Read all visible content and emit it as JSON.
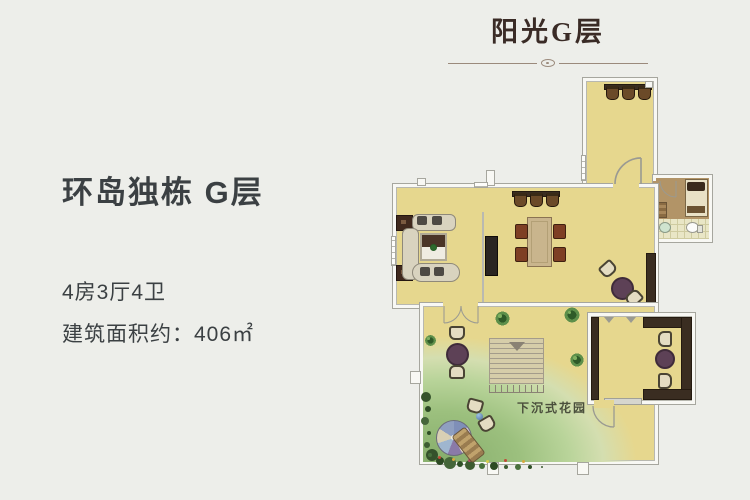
{
  "page": {
    "background": "#edeeea"
  },
  "header": {
    "title": "阳光G层",
    "title_color": "#3a2b26",
    "divider_color": "#9b8a7c"
  },
  "info": {
    "heading": "环岛独栋 G层",
    "spec_rooms": "4房3厅4卫",
    "spec_area": "建筑面积约：406㎡",
    "text_color": "#3b4043"
  },
  "floorplan": {
    "garden_label": "下沉式花园",
    "colors": {
      "floor": "#e6d78e",
      "wall_fill": "#f8f8f4",
      "wall_line": "#a6a69e",
      "dark_wood": "#3a2d21",
      "table_purple": "#5d4156",
      "dining_chair": "#7e3f24",
      "grass_green": "#9cc07e",
      "stair_tan": "#d6cda9",
      "bedroom_floor": "#b29467"
    }
  }
}
